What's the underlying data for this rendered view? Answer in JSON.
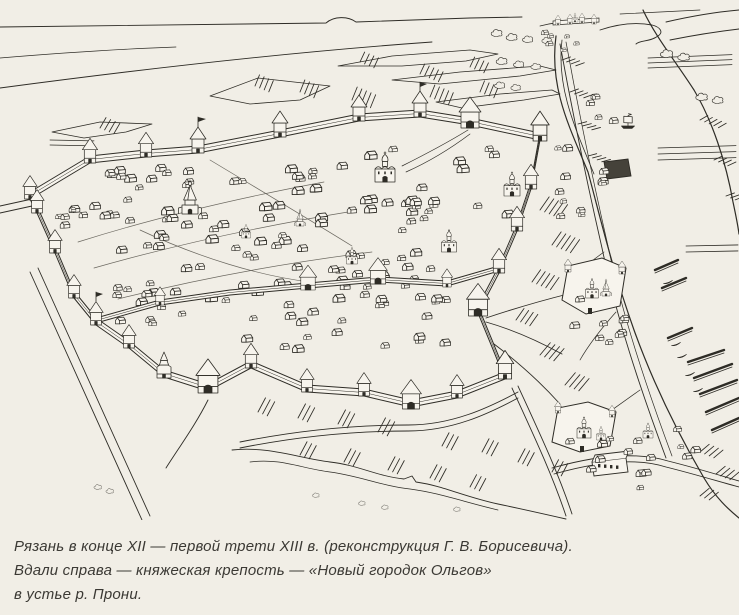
{
  "figure": {
    "type": "book illustration / scanned pen-and-ink bird's-eye reconstruction",
    "subject": "Old Ryazan, late 12th - first third of 13th century",
    "caption_lines": [
      "Рязань в конце XII — первой трети XIII в. (реконструкция  Г. В. Борисевича).",
      "Вдали справа — княжеская крепость — «Новый городок Ольгов»",
      "в устье р. Прони."
    ],
    "illustrated_features": [
      "fortress walls with tent-roof towers and gates",
      "dense timber housing inside the walls",
      "stone cathedral and churches",
      "river with boats, jetties and riverside monasteries",
      "distant fortress Novy Gorodok Olgov at the Pronya mouth",
      "ravines, roads and meadows"
    ],
    "colors": {
      "paper": "#f1eee6",
      "ink": "#2e2c26",
      "caption_text": "#3b3934"
    }
  }
}
